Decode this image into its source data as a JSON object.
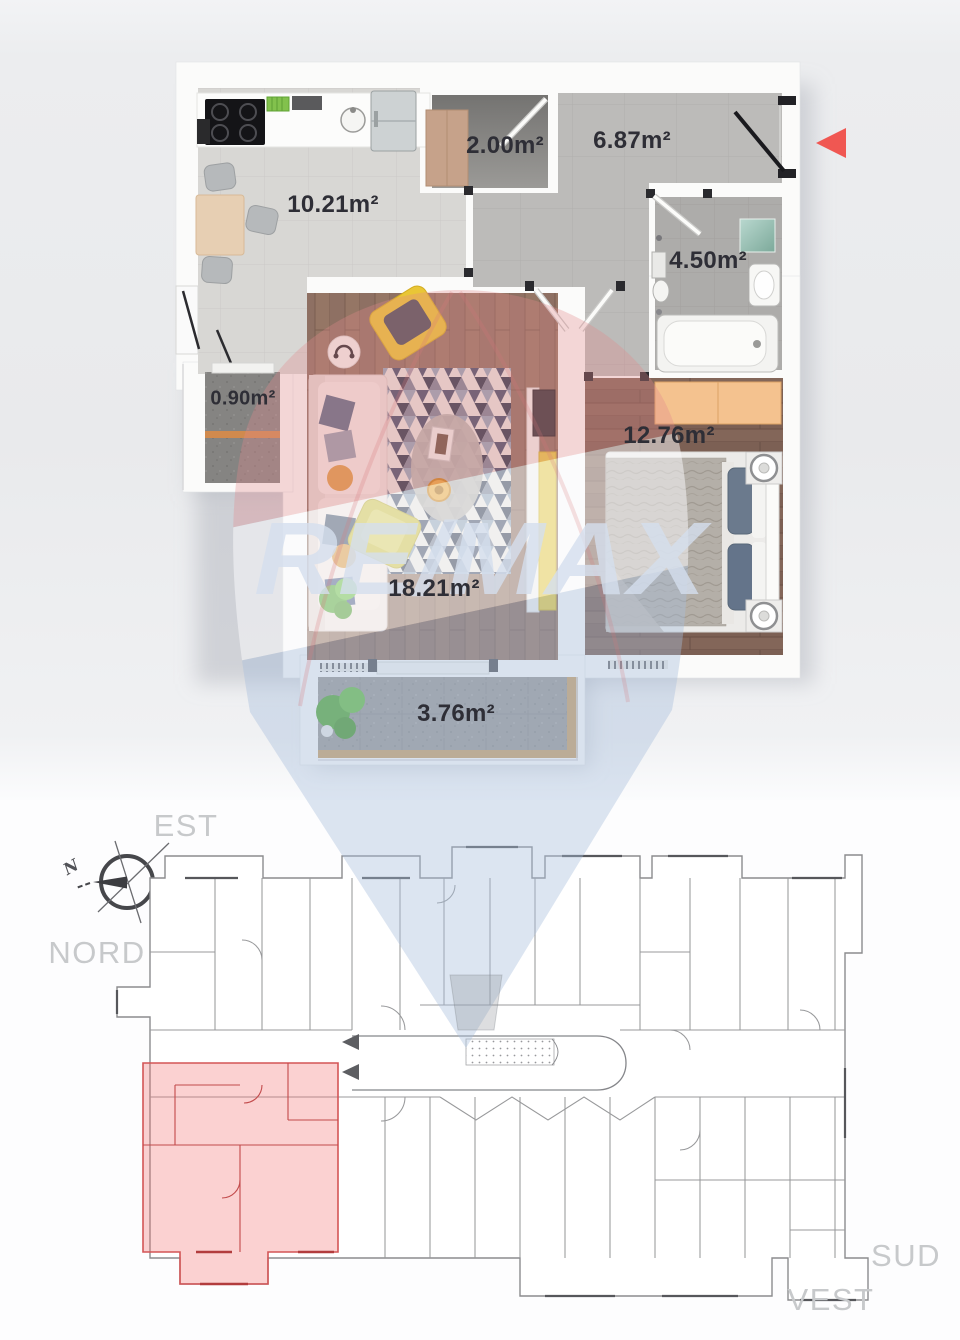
{
  "apartment_plan": {
    "rooms": [
      {
        "id": "kitchen-dining",
        "area_label": "10.21m²"
      },
      {
        "id": "closet",
        "area_label": "2.00m²"
      },
      {
        "id": "hallway",
        "area_label": "6.87m²"
      },
      {
        "id": "bathroom",
        "area_label": "4.50m²"
      },
      {
        "id": "north-balcony",
        "area_label": "0.90m²"
      },
      {
        "id": "living-room",
        "area_label": "18.21m²"
      },
      {
        "id": "bedroom",
        "area_label": "12.76m²"
      },
      {
        "id": "south-balcony",
        "area_label": "3.76m²"
      }
    ],
    "entrance_arrow_color": "#f05752"
  },
  "site_plan": {
    "compass": {
      "north_label": "N"
    },
    "directions": {
      "east": "EST",
      "north": "NORD",
      "south": "SUD",
      "west": "VEST"
    },
    "unit_highlight_color": "#f37070",
    "unit_entrance_arrow_color": "#5d5e62"
  },
  "watermark": {
    "text": "RE/MAX",
    "balloon_red": "#e2898c",
    "balloon_blue": "#a8bedb"
  }
}
